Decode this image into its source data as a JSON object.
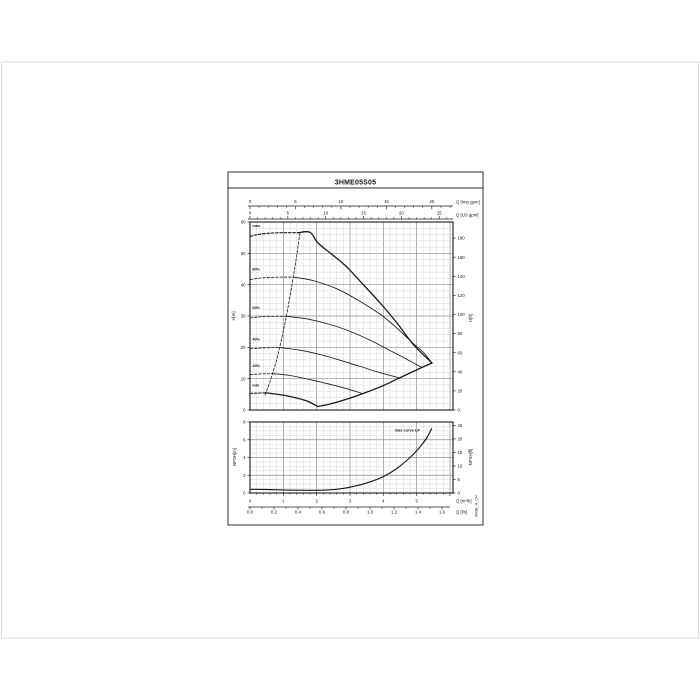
{
  "page": {
    "background": "#ffffff",
    "outer_frame_color": "#dadada"
  },
  "sheet": {
    "title": "3HME05S05",
    "side_text": "A03B_A_CH",
    "border_color": "#2b2b2b",
    "ink_color": "#1a1a1a",
    "grid_minor_color": "#c7c7c7",
    "grid_major_color": "#8f8f8f"
  },
  "chart_data": [
    {
      "type": "line",
      "title": "3HME05S05",
      "role": "head-vs-flow pump performance curves",
      "x_unit_internal": "m3/h",
      "x_max_m3h": 6.09,
      "xlabel_primary": "Q [Imp gpm]",
      "imp_gpm_ticks": [
        0,
        5,
        10,
        15,
        20
      ],
      "xlabel_secondary": "Q [US gpm]",
      "us_gpm_ticks": [
        0,
        5,
        10,
        15,
        20,
        25
      ],
      "ylabel_left": "H[m]",
      "ylim_m": [
        0,
        60
      ],
      "yticks_m": [
        0,
        10,
        20,
        30,
        40,
        50,
        60
      ],
      "ylabel_right": "H[ft]",
      "yticks_ft": [
        0,
        20,
        40,
        60,
        80,
        100,
        120,
        140,
        160,
        180
      ],
      "grid": true,
      "curve_labels": [
        {
          "text": "max",
          "q": 0.07,
          "H": 58.4
        },
        {
          "text": "80%",
          "q": 0.07,
          "H": 44.6
        },
        {
          "text": "60%",
          "q": 0.07,
          "H": 32.3
        },
        {
          "text": "40%",
          "q": 0.07,
          "H": 22.2
        },
        {
          "text": "20%",
          "q": 0.07,
          "H": 13.8
        },
        {
          "text": "min",
          "q": 0.07,
          "H": 7.5
        }
      ],
      "series": [
        {
          "name": "max-zeroflow",
          "style": "dashed",
          "width": 1.1,
          "points": [
            [
              0,
              55.4
            ],
            [
              0.3,
              56.1
            ],
            [
              0.7,
              56.5
            ],
            [
              1.1,
              56.6
            ],
            [
              1.45,
              56.6
            ]
          ]
        },
        {
          "name": "max",
          "style": "solid",
          "width": 1.3,
          "points": [
            [
              1.45,
              56.6
            ],
            [
              1.8,
              56.7
            ],
            [
              2.04,
              53.3
            ],
            [
              2.5,
              49.3
            ],
            [
              2.9,
              45.7
            ],
            [
              3.4,
              40.0
            ],
            [
              3.9,
              34.2
            ],
            [
              4.4,
              27.9
            ],
            [
              4.9,
              20.9
            ],
            [
              5.46,
              15.0
            ]
          ]
        },
        {
          "name": "80%-zeroflow",
          "style": "dashed",
          "width": 0.8,
          "points": [
            [
              0,
              41.6
            ],
            [
              0.4,
              42.2
            ],
            [
              0.9,
              42.4
            ],
            [
              1.3,
              42.4
            ]
          ]
        },
        {
          "name": "80%",
          "style": "solid",
          "width": 0.85,
          "points": [
            [
              1.3,
              42.4
            ],
            [
              1.9,
              41.3
            ],
            [
              2.6,
              38.7
            ],
            [
              3.2,
              35.3
            ],
            [
              3.9,
              30.6
            ],
            [
              4.4,
              26.2
            ],
            [
              4.9,
              21.2
            ],
            [
              5.2,
              18.4
            ],
            [
              5.46,
              15.0
            ]
          ]
        },
        {
          "name": "60%-zeroflow",
          "style": "dashed",
          "width": 0.8,
          "points": [
            [
              0,
              29.4
            ],
            [
              0.4,
              29.8
            ],
            [
              0.8,
              29.9
            ],
            [
              1.09,
              29.9
            ]
          ]
        },
        {
          "name": "60%",
          "style": "solid",
          "width": 0.85,
          "points": [
            [
              1.09,
              29.9
            ],
            [
              1.7,
              29.1
            ],
            [
              2.4,
              27.3
            ],
            [
              3.0,
              25.1
            ],
            [
              3.6,
              22.3
            ],
            [
              4.2,
              19.0
            ],
            [
              4.7,
              16.2
            ],
            [
              5.15,
              13.6
            ]
          ]
        },
        {
          "name": "40%-zeroflow",
          "style": "dashed",
          "width": 0.8,
          "points": [
            [
              0,
              19.5
            ],
            [
              0.35,
              19.8
            ],
            [
              0.7,
              19.9
            ],
            [
              0.89,
              19.9
            ]
          ]
        },
        {
          "name": "40%",
          "style": "solid",
          "width": 0.85,
          "points": [
            [
              0.89,
              19.9
            ],
            [
              1.5,
              19.1
            ],
            [
              2.1,
              17.7
            ],
            [
              2.7,
              15.9
            ],
            [
              3.3,
              13.9
            ],
            [
              3.9,
              11.9
            ],
            [
              4.5,
              10.2
            ]
          ]
        },
        {
          "name": "20%-zeroflow",
          "style": "dashed",
          "width": 0.8,
          "points": [
            [
              0,
              11.3
            ],
            [
              0.3,
              11.5
            ],
            [
              0.68,
              11.6
            ]
          ]
        },
        {
          "name": "20%",
          "style": "solid",
          "width": 0.85,
          "points": [
            [
              0.68,
              11.6
            ],
            [
              1.2,
              11.0
            ],
            [
              1.8,
              9.7
            ],
            [
              2.4,
              8.2
            ],
            [
              2.9,
              6.8
            ],
            [
              3.36,
              5.3
            ]
          ]
        },
        {
          "name": "min-zeroflow",
          "style": "dashed",
          "width": 1.1,
          "points": [
            [
              0,
              5.3
            ],
            [
              0.25,
              5.4
            ],
            [
              0.47,
              5.5
            ]
          ]
        },
        {
          "name": "min",
          "style": "solid",
          "width": 1.3,
          "points": [
            [
              0.47,
              5.5
            ],
            [
              0.9,
              4.9
            ],
            [
              1.3,
              4.1
            ],
            [
              1.7,
              2.9
            ],
            [
              2.04,
              1.1
            ]
          ]
        },
        {
          "name": "max-flow-envelope",
          "style": "solid",
          "width": 1.3,
          "points": [
            [
              2.04,
              1.1
            ],
            [
              2.5,
              2.2
            ],
            [
              3.0,
              3.8
            ],
            [
              3.5,
              5.7
            ],
            [
              4.0,
              7.8
            ],
            [
              4.5,
              10.3
            ],
            [
              5.0,
              12.8
            ],
            [
              5.46,
              15.0
            ]
          ]
        },
        {
          "name": "min-flow-line",
          "style": "dashed",
          "width": 0.8,
          "points": [
            [
              0.45,
              4.8
            ],
            [
              0.6,
              9.1
            ],
            [
              0.8,
              16.1
            ],
            [
              1.0,
              25.2
            ],
            [
              1.15,
              33.3
            ],
            [
              1.3,
              42.5
            ],
            [
              1.4,
              49.3
            ],
            [
              1.5,
              56.6
            ]
          ]
        }
      ]
    },
    {
      "type": "line",
      "title": "NPSH curve",
      "role": "NPSH-vs-flow",
      "x_unit_internal": "m3/h",
      "x_max_m3h": 6.09,
      "xlabel_m3h": "Q [m³/h]",
      "m3h_ticks": [
        0,
        1,
        2,
        3,
        4,
        5
      ],
      "xlabel_ls": "Q [l/s]",
      "ls_ticks": [
        0.0,
        0.2,
        0.4,
        0.6,
        0.8,
        1.0,
        1.2,
        1.4,
        1.6
      ],
      "ylabel_left": "NPSH[m]",
      "ylim_m": [
        0,
        8
      ],
      "yticks_m": [
        0,
        2,
        4,
        6,
        8
      ],
      "ylabel_right": "NPSH[ft]",
      "yticks_ft": [
        0,
        5,
        10,
        15,
        20,
        25
      ],
      "grid": true,
      "annotation": {
        "text": "max curve LP",
        "q": 4.72,
        "npsh_m": 6.95
      },
      "series": [
        {
          "name": "npsh-max-curve",
          "style": "solid",
          "width": 1.15,
          "points": [
            [
              0,
              0.42
            ],
            [
              0.5,
              0.39
            ],
            [
              1.0,
              0.35
            ],
            [
              1.5,
              0.31
            ],
            [
              2.0,
              0.3
            ],
            [
              2.4,
              0.36
            ],
            [
              2.8,
              0.52
            ],
            [
              3.2,
              0.82
            ],
            [
              3.6,
              1.25
            ],
            [
              4.0,
              1.85
            ],
            [
              4.4,
              2.75
            ],
            [
              4.8,
              4.0
            ],
            [
              5.1,
              5.2
            ],
            [
              5.3,
              6.2
            ],
            [
              5.45,
              7.25
            ]
          ]
        }
      ]
    }
  ]
}
